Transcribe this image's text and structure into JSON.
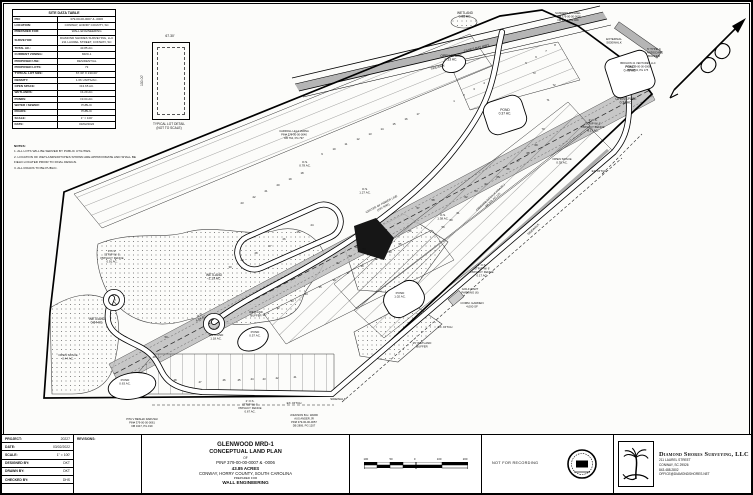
{
  "site_table": {
    "title": "SITE DATA TABLE",
    "rows": [
      [
        "PIN:",
        "379-00-00-0007 & -0006"
      ],
      [
        "LOCATION:",
        "CONWAY, HORRY COUNTY, SC"
      ],
      [
        "PREPARED FOR:",
        "WALL ENGINEERING"
      ],
      [
        "SURVEYOR:",
        "DIAMOND SHORES SURVEYING, LLC 211 LAUREL STREET, CONWAY, SC"
      ],
      [
        "TOTAL AC.:",
        "43.85 AC."
      ],
      [
        "CURRENT ZONING:",
        "MRD-1"
      ],
      [
        "PROPOSED USE:",
        "RESIDENTIAL"
      ],
      [
        "PROPOSED LOTS:",
        "73"
      ],
      [
        "TYPICAL LOT SIZE:",
        "67.30' X 130.00'"
      ],
      [
        "DENSITY:",
        "1.66 UNITS/AC."
      ],
      [
        "OPEN SPACE:",
        "±13.65 AC."
      ],
      [
        "WETLANDS:",
        "±4.29 AC."
      ],
      [
        "PONDS:",
        "±3.04 AC."
      ],
      [
        "WATER / SEWER:",
        "PUBLIC"
      ],
      [
        "ROADS:",
        "PUBLIC"
      ],
      [
        "SCALE:",
        "1\" = 100'"
      ],
      [
        "DATE:",
        "03/02/2022"
      ]
    ]
  },
  "notes": {
    "heading": "NOTES:",
    "items": [
      "ALL LOTS WILL BE SERVED BY PUBLIC UTILITIES.",
      "LOCATION OF WETLANDS/DITCHES SHOWN ARE APPROXIMATE AND SHALL BE FIELD LOCATED PRIOR TO FINAL DESIGN.",
      "ALL ROADS TO BE PUBLIC."
    ]
  },
  "lot_detail": {
    "width_dim": "67.30'",
    "depth_dim": "130.00'",
    "caption_line1": "TYPICAL LOT DETAIL",
    "caption_line2": "(NOT TO SCALE)"
  },
  "title_block": {
    "project_info": [
      [
        "PROJECT:",
        "20227"
      ],
      [
        "DATE:",
        "03/02/2022"
      ],
      [
        "SCALE:",
        "1\" = 100'"
      ],
      [
        "DESIGNED BY:",
        "DKT"
      ],
      [
        "DRAWN BY:",
        "DKT"
      ],
      [
        "CHECKED BY:",
        "DHS"
      ]
    ],
    "revisions_label": "REVISIONS:",
    "title_lines": [
      "GLENWOOD MRD-1",
      "CONCEPTUAL LAND PLAN",
      "OF",
      "PIN# 379-00-00-0007 & -0006",
      "43.85 ACRES",
      "CONWAY, HORRY COUNTY, SOUTH CAROLINA",
      "PREPARED FOR",
      "WALL ENGINEERING"
    ],
    "scale_ticks": [
      "100",
      "50",
      "0",
      "100",
      "200"
    ],
    "stamp_text": "NOT FOR RECORDING",
    "firm": {
      "name": "Diamond Shores Surveying, LLC",
      "addr1": "211 LAUREL STREET",
      "addr2": "CONWAY, SC 29526",
      "phone": "843.488.2802",
      "email": "OFFICE@DIAMONDSHORES.NET"
    }
  },
  "plan": {
    "colors": {
      "corridor": "#bdbdbd",
      "road_median": "#b5b5b5",
      "stipple_dot": "#666666",
      "dark_wetland": "#161616"
    },
    "labels": [
      {
        "t": "WETLAND\n0.08 AC.",
        "x": 463,
        "y": 12
      },
      {
        "t": "OPEN SPACE\n0.33 AC.",
        "x": 449,
        "y": 55
      },
      {
        "t": "SANDERS MICHAEL\nPIN# 379-00-00-0005\nDB 4414, PG 929",
        "x": 566,
        "y": 12,
        "s": 2.7
      },
      {
        "t": "CANES BAY HWY.",
        "x": 475,
        "y": 47,
        "r": -14,
        "s": 3.2
      },
      {
        "t": "SIDEWALK",
        "x": 436,
        "y": 66,
        "r": -14,
        "s": 2.8
      },
      {
        "t": "EXTERNAL\nSIDEWALK",
        "x": 612,
        "y": 38,
        "s": 3
      },
      {
        "t": "BROHON 41 VENTURES LLC\nPIN# 379-00-00-0008\nDB 3804, PG 175",
        "x": 636,
        "y": 62,
        "s": 2.6
      },
      {
        "t": "5' TYPE C\nLANDSCAPE\nBUFFER",
        "x": 652,
        "y": 48,
        "s": 3
      },
      {
        "t": "POND\n0.37 AC.",
        "x": 503,
        "y": 109
      },
      {
        "t": "POND\n0.45 AC.",
        "x": 628,
        "y": 66
      },
      {
        "t": "OPEN SPACE\n0.34 AC.",
        "x": 624,
        "y": 98
      },
      {
        "t": "2' O.S.\nSTRIP W/ 6'\nPRIVACY FENCE\n0.17 AC.",
        "x": 591,
        "y": 119,
        "s": 2.9
      },
      {
        "t": "OPEN SPACE\n0.35 AC.",
        "x": 560,
        "y": 158,
        "s": 3
      },
      {
        "t": "EX. DITCH",
        "x": 597,
        "y": 170,
        "s": 3
      },
      {
        "t": "CARROLL LELA VARNA\nPIN# 379-00-00-0040\nDB 764, PG 797",
        "x": 292,
        "y": 130,
        "s": 2.7
      },
      {
        "t": "O.S.\n0.78 AC.",
        "x": 303,
        "y": 161,
        "s": 3
      },
      {
        "t": "O.S.\n1.27 AC.",
        "x": 363,
        "y": 188,
        "s": 3
      },
      {
        "t": "CENTER OF POWER LINE\n(100' R/W)",
        "x": 380,
        "y": 203,
        "r": -28,
        "s": 2.9
      },
      {
        "t": "O.S.\n1.38 AC.",
        "x": 441,
        "y": 214,
        "s": 3
      },
      {
        "t": "CREEK/DB DITCH (4' HOA AC.)\nDB 378, PG 125",
        "x": 489,
        "y": 196,
        "r": -43,
        "s": 2.7
      },
      {
        "t": "SIDEWALK",
        "x": 532,
        "y": 228,
        "r": -43,
        "s": 3
      },
      {
        "t": "P.O.S.\nSTRIP W/ 6'\nPRIVACY FENCE\n0.91 AC.",
        "x": 110,
        "y": 250,
        "s": 2.9
      },
      {
        "t": "WETLAND\n~2.19 AC.",
        "x": 212,
        "y": 274
      },
      {
        "t": "WETLAND\n0.84 AC.",
        "x": 95,
        "y": 318
      },
      {
        "t": "O.S.\n6.84 AC.",
        "x": 198,
        "y": 314,
        "r": -28,
        "s": 3
      },
      {
        "t": "WETLAND\n1.18 AC.",
        "x": 214,
        "y": 334,
        "s": 3
      },
      {
        "t": "WETLAND\nBUFFER",
        "x": 254,
        "y": 311,
        "s": 2.8
      },
      {
        "t": "POND\n0.57 AC.",
        "x": 253,
        "y": 331,
        "s": 3
      },
      {
        "t": "OPEN SPACE\n0.44 AC.",
        "x": 66,
        "y": 354,
        "s": 3
      },
      {
        "t": "POND\n0.63 AC.",
        "x": 123,
        "y": 379,
        "s": 3
      },
      {
        "t": "2' O.S.\nSTRIP W/ 6'\nPRIVACY FENCE\n0.67 AC.",
        "x": 248,
        "y": 400,
        "s": 2.9
      },
      {
        "t": "EX. DITCH",
        "x": 292,
        "y": 402,
        "s": 3
      },
      {
        "t": "SIDEWALK",
        "x": 336,
        "y": 398,
        "s": 3
      },
      {
        "t": "PITA V BESHAI DARUSHI\nPIN# 379-00-00-0061\nDB 3447, PG 199",
        "x": 140,
        "y": 418,
        "s": 2.7
      },
      {
        "t": "JOHNSON B.H. WARD\nAUS ANDER JR\nPIN# 379-00-00-0057\nDB 2806, PG 1207",
        "x": 302,
        "y": 414,
        "s": 2.7
      },
      {
        "t": "POND\n1.02 AC.",
        "x": 398,
        "y": 292,
        "s": 3
      },
      {
        "t": "GOLF CART\nPARKING (6)",
        "x": 468,
        "y": 288,
        "s": 2.9
      },
      {
        "t": "COMM. GARDEN\n4,000 SF",
        "x": 470,
        "y": 302,
        "s": 2.9
      },
      {
        "t": "EX. DITCH",
        "x": 443,
        "y": 326,
        "s": 3
      },
      {
        "t": "25' WETLAND\nBUFFER",
        "x": 420,
        "y": 342,
        "s": 2.9
      },
      {
        "t": "2' O.S.\nSTRIP W/ 6'\nPRIVACY FENCE\n0.17 AC.",
        "x": 480,
        "y": 264,
        "s": 2.9
      }
    ],
    "lots": [
      {
        "n": 1,
        "x": 452,
        "y": 100
      },
      {
        "n": 2,
        "x": 462,
        "y": 94
      },
      {
        "n": 3,
        "x": 472,
        "y": 88
      },
      {
        "n": 4,
        "x": 482,
        "y": 82
      },
      {
        "n": 5,
        "x": 524,
        "y": 62
      },
      {
        "n": 6,
        "x": 534,
        "y": 56
      },
      {
        "n": 7,
        "x": 544,
        "y": 50
      },
      {
        "n": 8,
        "x": 553,
        "y": 44
      },
      {
        "n": 9,
        "x": 320,
        "y": 153
      },
      {
        "n": 10,
        "x": 332,
        "y": 148
      },
      {
        "n": 11,
        "x": 344,
        "y": 143
      },
      {
        "n": 12,
        "x": 356,
        "y": 138
      },
      {
        "n": 13,
        "x": 368,
        "y": 133
      },
      {
        "n": 14,
        "x": 380,
        "y": 128
      },
      {
        "n": 15,
        "x": 392,
        "y": 123
      },
      {
        "n": 16,
        "x": 404,
        "y": 118
      },
      {
        "n": 17,
        "x": 416,
        "y": 113
      },
      {
        "n": 18,
        "x": 300,
        "y": 172
      },
      {
        "n": 19,
        "x": 288,
        "y": 178
      },
      {
        "n": 20,
        "x": 276,
        "y": 184
      },
      {
        "n": 21,
        "x": 264,
        "y": 190
      },
      {
        "n": 22,
        "x": 252,
        "y": 196
      },
      {
        "n": 23,
        "x": 240,
        "y": 202
      },
      {
        "n": 24,
        "x": 310,
        "y": 224
      },
      {
        "n": 25,
        "x": 296,
        "y": 231
      },
      {
        "n": 26,
        "x": 282,
        "y": 238
      },
      {
        "n": 27,
        "x": 268,
        "y": 245
      },
      {
        "n": 28,
        "x": 254,
        "y": 252
      },
      {
        "n": 29,
        "x": 240,
        "y": 259
      },
      {
        "n": 30,
        "x": 228,
        "y": 266
      },
      {
        "n": 31,
        "x": 262,
        "y": 314
      },
      {
        "n": 32,
        "x": 276,
        "y": 307
      },
      {
        "n": 33,
        "x": 290,
        "y": 300
      },
      {
        "n": 34,
        "x": 304,
        "y": 293
      },
      {
        "n": 35,
        "x": 318,
        "y": 286
      },
      {
        "n": 36,
        "x": 332,
        "y": 279
      },
      {
        "n": 37,
        "x": 346,
        "y": 272
      },
      {
        "n": 38,
        "x": 360,
        "y": 265
      },
      {
        "n": 39,
        "x": 374,
        "y": 258
      },
      {
        "n": 40,
        "x": 388,
        "y": 251
      },
      {
        "n": 41,
        "x": 293,
        "y": 376
      },
      {
        "n": 42,
        "x": 275,
        "y": 377
      },
      {
        "n": 43,
        "x": 262,
        "y": 378
      },
      {
        "n": 44,
        "x": 250,
        "y": 378
      },
      {
        "n": 45,
        "x": 237,
        "y": 379
      },
      {
        "n": 46,
        "x": 222,
        "y": 379
      },
      {
        "n": 47,
        "x": 198,
        "y": 381
      },
      {
        "n": 48,
        "x": 173,
        "y": 379
      },
      {
        "n": 49,
        "x": 152,
        "y": 356
      },
      {
        "n": 50,
        "x": 164,
        "y": 336
      },
      {
        "n": 51,
        "x": 354,
        "y": 246
      },
      {
        "n": 52,
        "x": 336,
        "y": 262
      },
      {
        "n": 53,
        "x": 348,
        "y": 255
      },
      {
        "n": 54,
        "x": 362,
        "y": 248
      },
      {
        "n": 55,
        "x": 398,
        "y": 243
      },
      {
        "n": 56,
        "x": 408,
        "y": 230
      },
      {
        "n": 57,
        "x": 416,
        "y": 207
      },
      {
        "n": 58,
        "x": 431,
        "y": 199
      },
      {
        "n": 59,
        "x": 441,
        "y": 226
      },
      {
        "n": 60,
        "x": 449,
        "y": 219
      },
      {
        "n": 61,
        "x": 456,
        "y": 212
      },
      {
        "n": 62,
        "x": 464,
        "y": 196
      },
      {
        "n": 63,
        "x": 474,
        "y": 190
      },
      {
        "n": 64,
        "x": 484,
        "y": 183
      },
      {
        "n": 65,
        "x": 496,
        "y": 176
      },
      {
        "n": 66,
        "x": 506,
        "y": 168
      },
      {
        "n": 67,
        "x": 516,
        "y": 160
      },
      {
        "n": 68,
        "x": 526,
        "y": 152
      },
      {
        "n": 69,
        "x": 534,
        "y": 144
      },
      {
        "n": 70,
        "x": 541,
        "y": 128
      },
      {
        "n": 71,
        "x": 546,
        "y": 99
      },
      {
        "n": 72,
        "x": 552,
        "y": 84
      },
      {
        "n": 73,
        "x": 532,
        "y": 72
      }
    ]
  }
}
